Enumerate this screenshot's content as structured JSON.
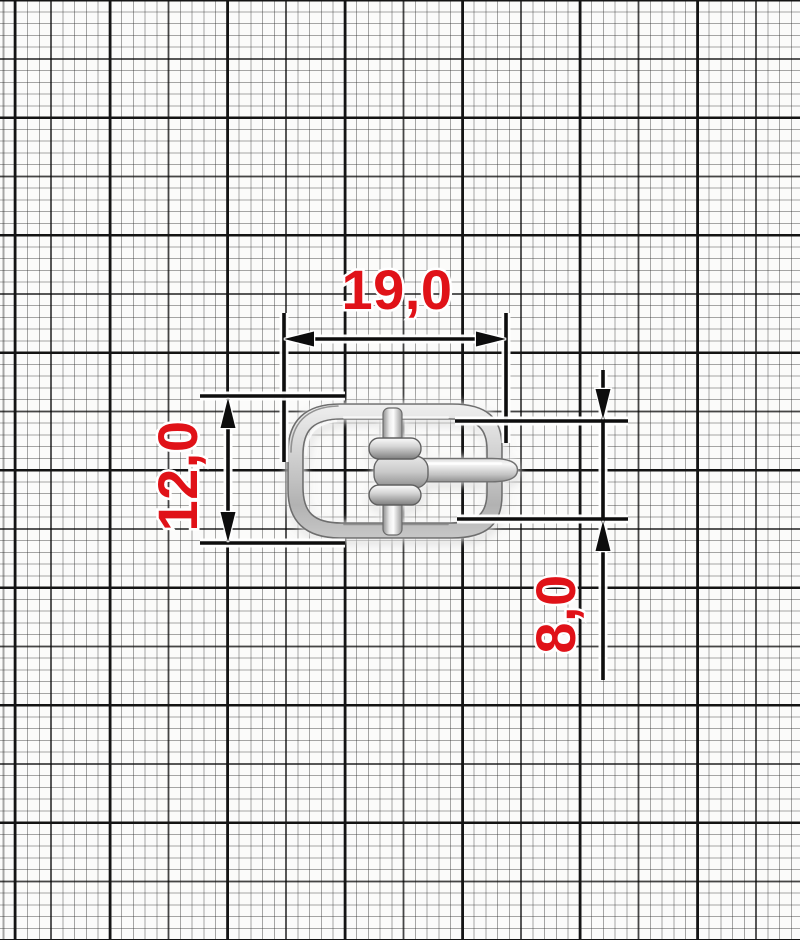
{
  "drawing": {
    "part": "belt-buckle-with-prong",
    "paper": "millimeter-grid",
    "dimensions": {
      "width": {
        "label": "19,0",
        "orientation": "horizontal"
      },
      "height": {
        "label": "12,0",
        "orientation": "vertical"
      },
      "inner_height": {
        "label": "8,0",
        "orientation": "vertical"
      }
    },
    "colors": {
      "dimension_text": "#e01218",
      "dimension_line": "#0d0d0d",
      "grid_major": "#141414",
      "paper": "#fbfbfa",
      "metal_light": "#f5f5f5",
      "metal_mid": "#c9c9c9",
      "metal_dark": "#8f8f8f"
    }
  }
}
